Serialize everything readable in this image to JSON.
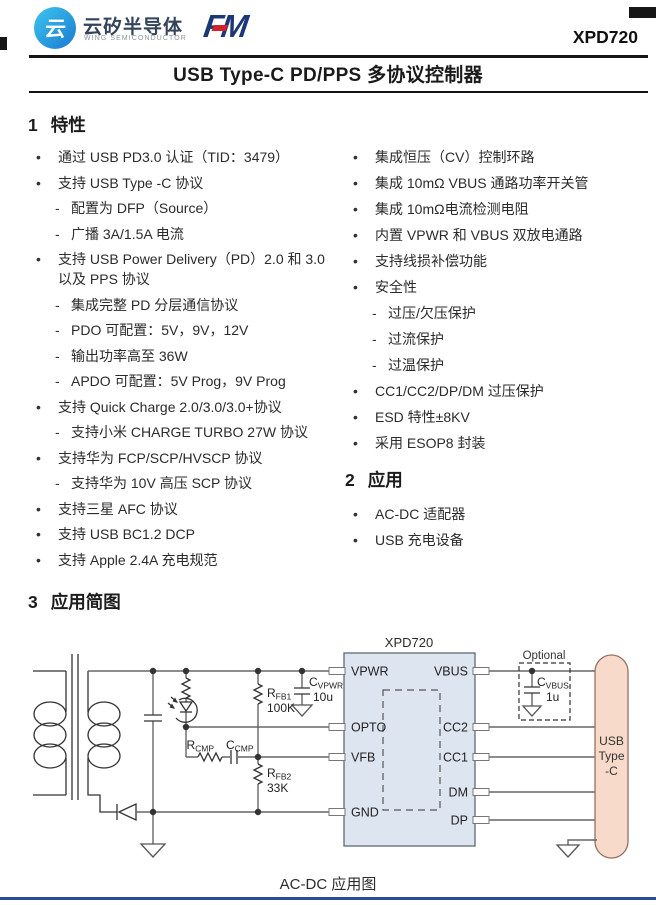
{
  "header": {
    "brand_cn": "云矽半导体",
    "brand_en": "WING SEMICONDUCTOR",
    "logo_glyph": "云",
    "fm_text": "FM",
    "part_number": "XPD720"
  },
  "title": "USB Type-C PD/PPS 多协议控制器",
  "sections": {
    "features": {
      "num": "1",
      "title": "特性"
    },
    "applications": {
      "num": "2",
      "title": "应用"
    },
    "diagram": {
      "num": "3",
      "title": "应用简图"
    }
  },
  "features_left": [
    {
      "type": "bullet",
      "marker": "•",
      "text": "通过 USB PD3.0 认证（TID：3479）"
    },
    {
      "type": "bullet",
      "marker": "•",
      "text": "支持 USB Type -C 协议"
    },
    {
      "type": "dash",
      "marker": "-",
      "text": "配置为 DFP（Source）"
    },
    {
      "type": "dash",
      "marker": "-",
      "text": "广播 3A/1.5A 电流"
    },
    {
      "type": "bullet",
      "marker": "•",
      "text": "支持 USB Power Delivery（PD）2.0 和 3.0 以及 PPS 协议"
    },
    {
      "type": "dash",
      "marker": "-",
      "text": "集成完整 PD 分层通信协议"
    },
    {
      "type": "dash",
      "marker": "-",
      "text": "PDO 可配置：5V，9V，12V"
    },
    {
      "type": "dash",
      "marker": "-",
      "text": "输出功率高至 36W"
    },
    {
      "type": "dash",
      "marker": "-",
      "text": "APDO 可配置：5V Prog，9V Prog"
    },
    {
      "type": "bullet",
      "marker": "•",
      "text": "支持 Quick Charge 2.0/3.0/3.0+协议"
    },
    {
      "type": "dash",
      "marker": "-",
      "text": "支持小米 CHARGE TURBO 27W 协议"
    },
    {
      "type": "bullet",
      "marker": "•",
      "text": "支持华为 FCP/SCP/HVSCP 协议"
    },
    {
      "type": "dash",
      "marker": "-",
      "text": "支持华为 10V 高压 SCP 协议"
    },
    {
      "type": "bullet",
      "marker": "•",
      "text": "支持三星 AFC 协议"
    },
    {
      "type": "bullet",
      "marker": "•",
      "text": "支持 USB BC1.2 DCP"
    },
    {
      "type": "bullet",
      "marker": "•",
      "text": "支持 Apple 2.4A 充电规范"
    }
  ],
  "features_right": [
    {
      "type": "bullet",
      "marker": "•",
      "text": "集成恒压（CV）控制环路"
    },
    {
      "type": "bullet",
      "marker": "•",
      "text": "集成 10mΩ VBUS 通路功率开关管"
    },
    {
      "type": "bullet",
      "marker": "•",
      "text": "集成 10mΩ电流检测电阻"
    },
    {
      "type": "bullet",
      "marker": "•",
      "text": "内置 VPWR 和 VBUS 双放电通路"
    },
    {
      "type": "bullet",
      "marker": "•",
      "text": "支持线损补偿功能"
    },
    {
      "type": "bullet",
      "marker": "•",
      "text": "安全性"
    },
    {
      "type": "dash",
      "marker": "-",
      "text": "过压/欠压保护"
    },
    {
      "type": "dash",
      "marker": "-",
      "text": "过流保护"
    },
    {
      "type": "dash",
      "marker": "-",
      "text": "过温保护"
    },
    {
      "type": "bullet",
      "marker": "•",
      "text": "CC1/CC2/DP/DM 过压保护"
    },
    {
      "type": "bullet",
      "marker": "•",
      "text": "ESD 特性±8KV"
    },
    {
      "type": "bullet",
      "marker": "•",
      "text": "采用 ESOP8 封装"
    }
  ],
  "applications_items": [
    {
      "type": "bullet",
      "marker": "•",
      "text": "AC-DC 适配器"
    },
    {
      "type": "bullet",
      "marker": "•",
      "text": "USB 充电设备"
    }
  ],
  "schematic": {
    "ic_name": "XPD720",
    "pins_left": [
      "VPWR",
      "OPTO",
      "VFB",
      "GND"
    ],
    "pins_right": [
      "VBUS",
      "CC2",
      "CC1",
      "DM",
      "DP"
    ],
    "components": {
      "rfb1": {
        "ref": "R",
        "sub": "FB1",
        "value": "100K"
      },
      "rfb2": {
        "ref": "R",
        "sub": "FB2",
        "value": "33K"
      },
      "rcmp": {
        "ref": "R",
        "sub": "CMP"
      },
      "ccmp": {
        "ref": "C",
        "sub": "CMP"
      },
      "cvpwr": {
        "ref": "C",
        "sub": "VPWR",
        "value": "10u"
      },
      "cvbus": {
        "ref": "C",
        "sub": "VBUS",
        "value": "1u"
      }
    },
    "optional_label": "Optional",
    "connector": {
      "line1": "USB",
      "line2": "Type",
      "line3": "-C"
    },
    "caption": "AC-DC 应用图"
  },
  "colors": {
    "ic_fill": "#dde5f0",
    "connector_fill": "#f7dac9",
    "brand_navy": "#1c3776",
    "brand_red": "#d2232a",
    "logo_cyan": "#3cc6ef",
    "logo_blue": "#1b79d2",
    "bottom_rule": "#2b4a9b"
  }
}
